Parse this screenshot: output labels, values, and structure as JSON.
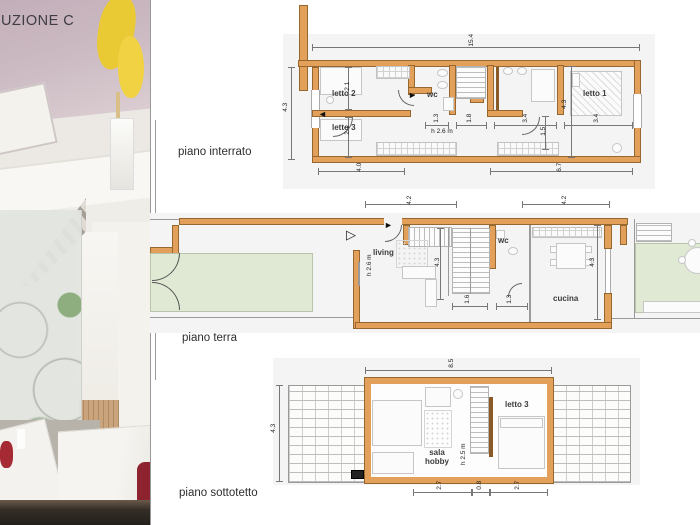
{
  "title": "UZIONE C",
  "icons": {
    "entrance_arrow": "▷",
    "door_swing_right": "►",
    "door_swing_left": "◄"
  },
  "colors": {
    "wall_orange": "#e2a05a",
    "backdrop_gray": "#f4f4f4",
    "garden_green": "#e0e9d3"
  },
  "plans": {
    "interrato": {
      "label": "piano interrato",
      "rooms": {
        "letto2": "letto 2",
        "letto3": "letto 3",
        "wc": "wc",
        "letto1": "letto 1"
      },
      "height_note": "h 2.6 m",
      "dims": {
        "total_width": "15.4",
        "left_height": "4.3",
        "letto2_depth": "2.1",
        "letto3_depth": "2.1",
        "bottom_left": "4.0",
        "bottom_right": "6.7",
        "wc_width": "1.3",
        "stair_width": "1.8",
        "bath_width": "3.4",
        "bed_clearance": "1.5",
        "letto1_width": "3.4",
        "inner_height": "4.3"
      }
    },
    "terra": {
      "label": "piano terra",
      "rooms": {
        "living": "living",
        "wc": "wc",
        "cucina": "cucina"
      },
      "height_note": "h 2.6 m",
      "dims": {
        "top_left": "4.2",
        "top_right": "4.2",
        "inner_height": "4.3",
        "right_height": "4.3",
        "stair_width": "1.6",
        "wc_width": "1.3"
      }
    },
    "sottotetto": {
      "label": "piano sottotetto",
      "rooms": {
        "sala_hobby": "sala hobby",
        "letto3": "letto 3"
      },
      "height_note": "h 2.5 m",
      "dims": {
        "top_width": "8.5",
        "left_height": "4.3",
        "bottom_left": "2.7",
        "bottom_mid": "0.8",
        "bottom_right": "2.7"
      }
    }
  }
}
